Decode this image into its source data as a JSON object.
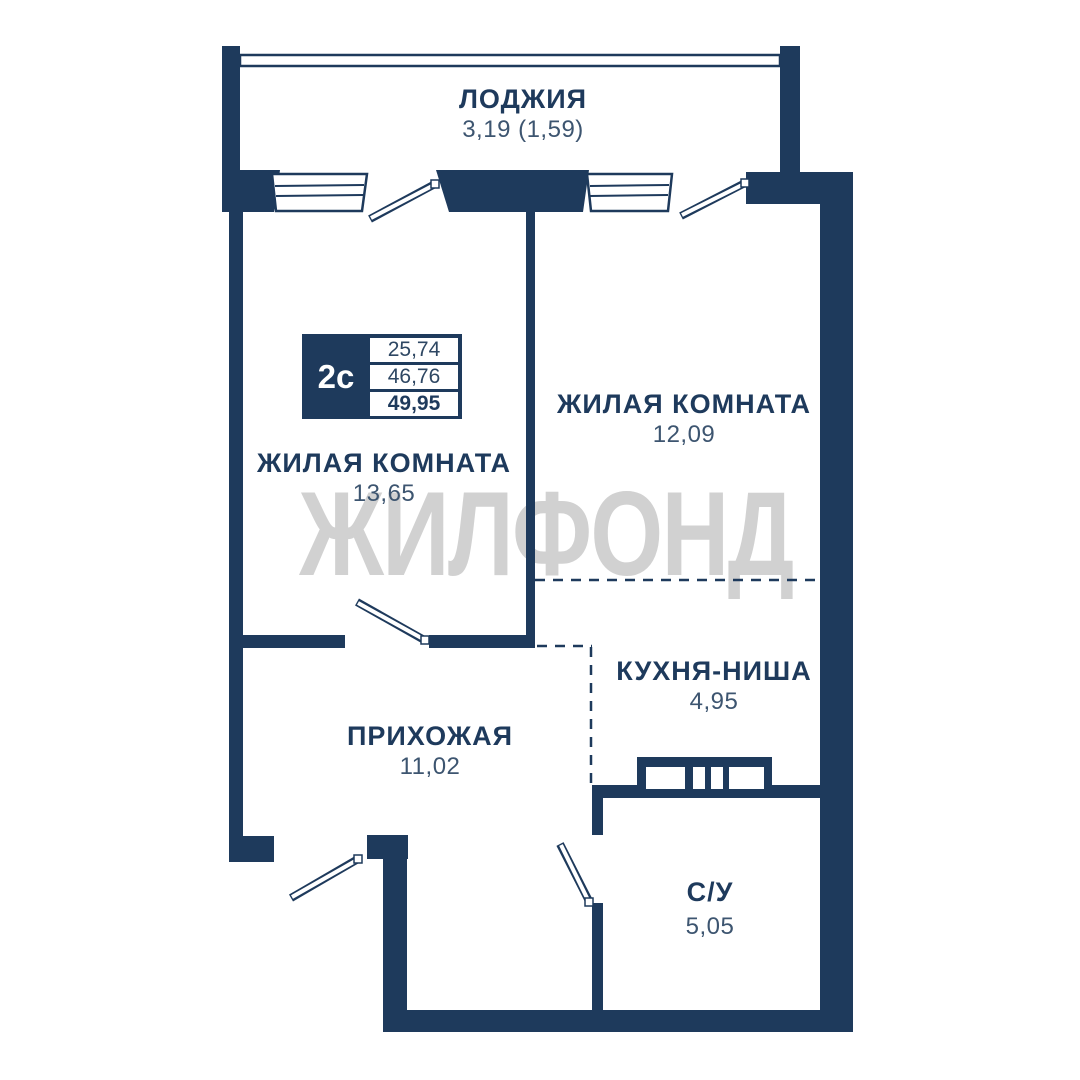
{
  "watermark": {
    "text": "ЖИЛФОНД",
    "color": "#d1d1d1"
  },
  "colors": {
    "walls": "#1e3a5c",
    "room_label": "#1e3a5c",
    "room_value": "#3d5570",
    "watermark": "#d1d1d1",
    "background": "#ffffff"
  },
  "info_badge": {
    "apartment_type": "2с",
    "areas": [
      "25,74",
      "46,76",
      "49,95"
    ]
  },
  "rooms": [
    {
      "id": "loggia",
      "name": "ЛОДЖИЯ",
      "area": "3,19 (1,59)"
    },
    {
      "id": "living-room-right",
      "name": "ЖИЛАЯ КОМНАТА",
      "area": "12,09"
    },
    {
      "id": "living-room-left",
      "name": "ЖИЛАЯ КОМНАТА",
      "area": "13,65"
    },
    {
      "id": "kitchen-niche",
      "name": "КУХНЯ-НИША",
      "area": "4,95"
    },
    {
      "id": "hallway",
      "name": "ПРИХОЖАЯ",
      "area": "11,02"
    },
    {
      "id": "bathroom",
      "name": "С/У",
      "area": "5,05"
    }
  ]
}
